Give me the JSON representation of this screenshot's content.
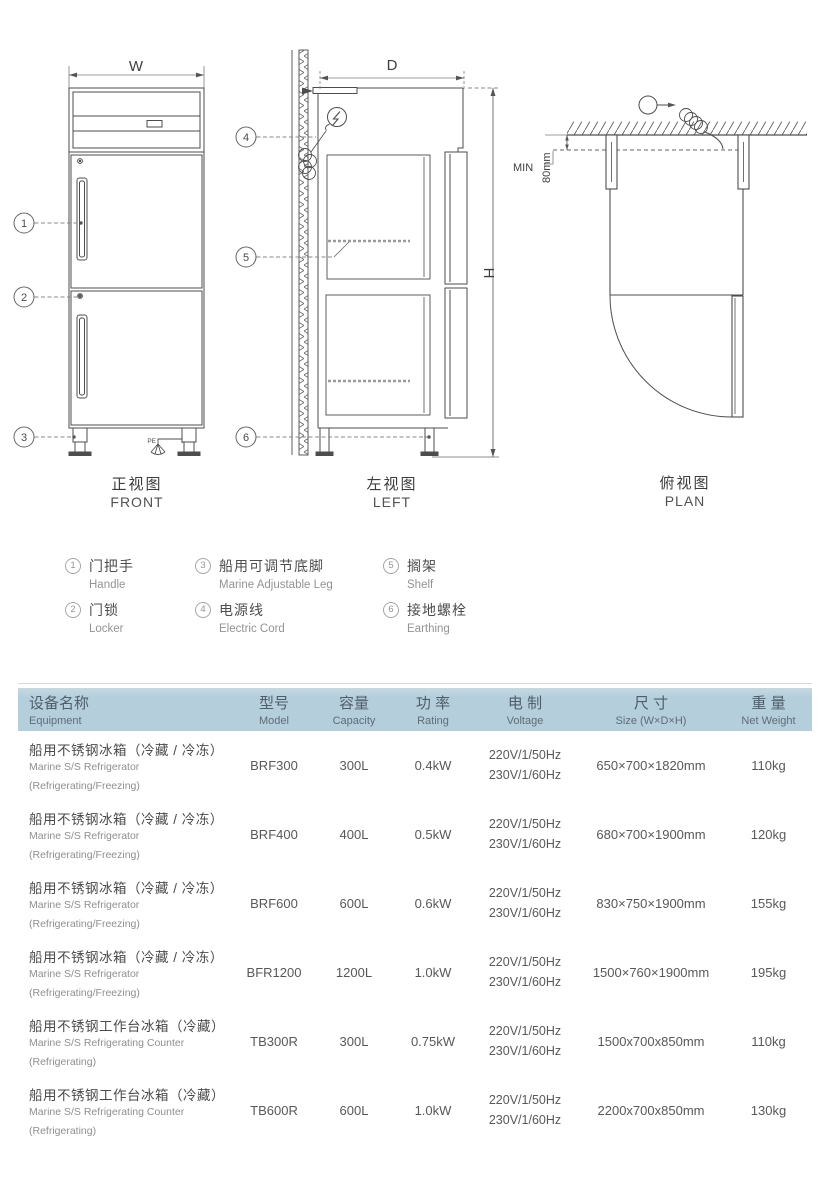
{
  "views": {
    "front": {
      "label_zh": "正视图",
      "label_en": "FRONT",
      "dim_width": "W",
      "pe": "PE",
      "callout_1": "1",
      "callout_2": "2",
      "callout_3": "3"
    },
    "left": {
      "label_zh": "左视图",
      "label_en": "LEFT",
      "dim_depth": "D",
      "dim_height": "H",
      "callout_4": "4",
      "callout_5": "5",
      "callout_6": "6"
    },
    "plan": {
      "label_zh": "俯视图",
      "label_en": "PLAN",
      "min_label": "MIN",
      "clearance": "80mm"
    }
  },
  "legend": {
    "items": [
      {
        "num": "1",
        "zh": "门把手",
        "en": "Handle"
      },
      {
        "num": "2",
        "zh": "门锁",
        "en": "Locker"
      },
      {
        "num": "3",
        "zh": "船用可调节底脚",
        "en": "Marine Adjustable Leg"
      },
      {
        "num": "4",
        "zh": "电源线",
        "en": "Electric Cord"
      },
      {
        "num": "5",
        "zh": "搁架",
        "en": "Shelf"
      },
      {
        "num": "6",
        "zh": "接地螺栓",
        "en": "Earthing"
      }
    ]
  },
  "table": {
    "header_bg": "#b5cedc",
    "columns": [
      {
        "zh": "设备名称",
        "en": "Equipment"
      },
      {
        "zh": "型号",
        "en": "Model"
      },
      {
        "zh": "容量",
        "en": "Capacity"
      },
      {
        "zh": "功 率",
        "en": "Rating"
      },
      {
        "zh": "电 制",
        "en": "Voltage"
      },
      {
        "zh": "尺 寸",
        "en": "Size (W×D×H)"
      },
      {
        "zh": "重 量",
        "en": "Net Weight"
      }
    ],
    "rows": [
      {
        "name_zh": "船用不锈钢冰箱（冷藏 / 冷冻）",
        "name_en": "Marine S/S Refrigerator",
        "name_sub": "(Refrigerating/Freezing)",
        "model": "BRF300",
        "capacity": "300L",
        "rating": "0.4kW",
        "volt1": "220V/1/50Hz",
        "volt2": "230V/1/60Hz",
        "size": "650×700×1820mm",
        "weight": "110kg"
      },
      {
        "name_zh": "船用不锈钢冰箱（冷藏 / 冷冻）",
        "name_en": "Marine S/S Refrigerator",
        "name_sub": "(Refrigerating/Freezing)",
        "model": "BRF400",
        "capacity": "400L",
        "rating": "0.5kW",
        "volt1": "220V/1/50Hz",
        "volt2": "230V/1/60Hz",
        "size": "680×700×1900mm",
        "weight": "120kg"
      },
      {
        "name_zh": "船用不锈钢冰箱（冷藏 / 冷冻）",
        "name_en": "Marine S/S Refrigerator",
        "name_sub": "(Refrigerating/Freezing)",
        "model": "BRF600",
        "capacity": "600L",
        "rating": "0.6kW",
        "volt1": "220V/1/50Hz",
        "volt2": "230V/1/60Hz",
        "size": "830×750×1900mm",
        "weight": "155kg"
      },
      {
        "name_zh": "船用不锈钢冰箱（冷藏 / 冷冻）",
        "name_en": "Marine S/S Refrigerator",
        "name_sub": "(Refrigerating/Freezing)",
        "model": "BFR1200",
        "capacity": "1200L",
        "rating": "1.0kW",
        "volt1": "220V/1/50Hz",
        "volt2": "230V/1/60Hz",
        "size": "1500×760×1900mm",
        "weight": "195kg"
      },
      {
        "name_zh": "船用不锈钢工作台冰箱（冷藏）",
        "name_en": "Marine S/S Refrigerating Counter",
        "name_sub": "(Refrigerating)",
        "model": "TB300R",
        "capacity": "300L",
        "rating": "0.75kW",
        "volt1": "220V/1/50Hz",
        "volt2": "230V/1/60Hz",
        "size": "1500x700x850mm",
        "weight": "110kg"
      },
      {
        "name_zh": "船用不锈钢工作台冰箱（冷藏）",
        "name_en": "Marine S/S Refrigerating Counter",
        "name_sub": "(Refrigerating)",
        "model": "TB600R",
        "capacity": "600L",
        "rating": "1.0kW",
        "volt1": "220V/1/50Hz",
        "volt2": "230V/1/60Hz",
        "size": "2200x700x850mm",
        "weight": "130kg"
      }
    ]
  }
}
